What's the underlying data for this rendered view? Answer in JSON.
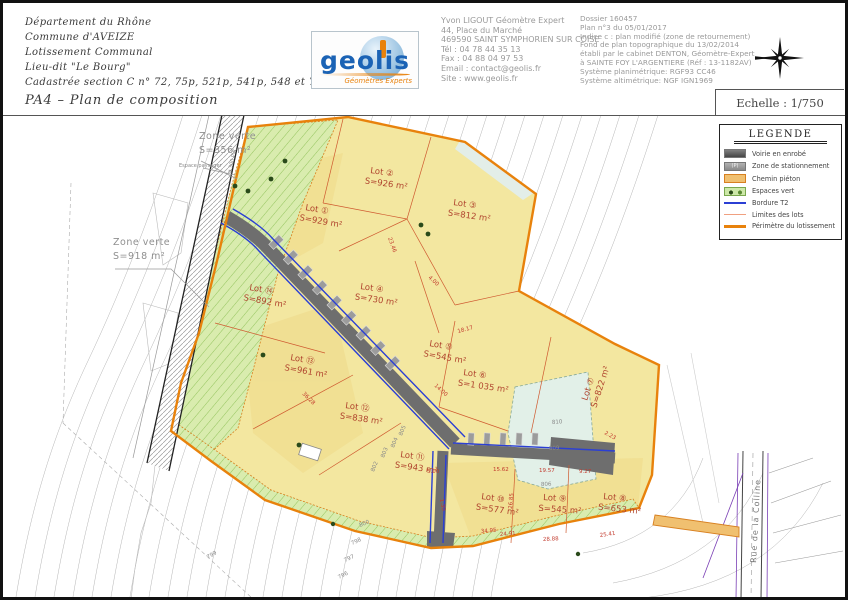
{
  "header": {
    "left_lines": [
      "Département du Rhône",
      "Commune d'AVEIZE",
      "Lotissement Communal",
      "Lieu-dit \"Le Bourg\"",
      "Cadastrée section C n° 72, 75p, 521p, 541p, 548 et 702",
      "PA4 – Plan de composition"
    ],
    "logo": {
      "name": "geolis",
      "tagline": "Géomètres Experts"
    },
    "contact_lines": [
      "Yvon LIGOUT Géomètre Expert",
      "44, Place du Marché",
      "469590 SAINT SYMPHORIEN SUR COISE",
      "Tél : 04 78 44 35 13",
      "Fax : 04 88 04 97 53",
      "Email : contact@geolis.fr",
      "Site : www.geolis.fr"
    ],
    "dossier_lines": [
      "Dossier 160457",
      "Plan n°3 du 05/01/2017",
      "Indice c : plan modifié (zone de retournement)",
      "Fond de plan topographique du 13/02/2014",
      "établi par le cabinet DENTON, Géomètre-Expert",
      "à SAINTE FOY L'ARGENTIERE (Réf : 13-1182AV)",
      "Système planimétrique: RGF93 CC46",
      "Système altimétrique: NGF IGN1969"
    ],
    "scale": "Echelle : 1/750"
  },
  "legend": {
    "title": "LEGENDE",
    "entries": [
      {
        "label": "Voirie en enrobé",
        "swatch": "road",
        "swatch_text": ""
      },
      {
        "label": "Zone de stationnement",
        "swatch": "parking",
        "swatch_text": "(P)"
      },
      {
        "label": "Chemin piéton",
        "swatch": "path",
        "swatch_text": ""
      },
      {
        "label": "Espaces vert",
        "swatch": "green",
        "swatch_text": ""
      },
      {
        "label": "Bordure T2",
        "swatch": "bordure",
        "swatch_text": ""
      },
      {
        "label": "Limites des lots",
        "swatch": "limites",
        "swatch_text": ""
      },
      {
        "label": "Périmètre du lotissement",
        "swatch": "perimetre",
        "swatch_text": ""
      }
    ]
  },
  "map": {
    "lots": [
      {
        "name": "Lot ①",
        "area": "S=929 m²",
        "x": 302,
        "y": 207,
        "rot": 10
      },
      {
        "name": "Lot ②",
        "area": "S=926 m²",
        "x": 367,
        "y": 170,
        "rot": 8
      },
      {
        "name": "Lot ③",
        "area": "S=812 m²",
        "x": 450,
        "y": 202,
        "rot": 8
      },
      {
        "name": "Lot ④",
        "area": "S=730 m²",
        "x": 357,
        "y": 286,
        "rot": 8
      },
      {
        "name": "Lot ⑤",
        "area": "S=545 m²",
        "x": 426,
        "y": 343,
        "rot": 10
      },
      {
        "name": "Lot ⑥",
        "area": "S=1 035 m²",
        "x": 460,
        "y": 372,
        "rot": 8
      },
      {
        "name": "Lot ⑦",
        "area": "S=822 m²",
        "x": 584,
        "y": 398,
        "rot": -72
      },
      {
        "name": "Lot ⑧",
        "area": "S=653 m²",
        "x": 600,
        "y": 496,
        "rot": 6
      },
      {
        "name": "Lot ⑨",
        "area": "S=545 m²",
        "x": 540,
        "y": 497,
        "rot": 4
      },
      {
        "name": "Lot ⑩",
        "area": "S=577 m²",
        "x": 478,
        "y": 496,
        "rot": 8
      },
      {
        "name": "Lot ⑪",
        "area": "S=943 m²",
        "x": 397,
        "y": 454,
        "rot": 8
      },
      {
        "name": "Lot ⑫",
        "area": "S=838 m²",
        "x": 342,
        "y": 405,
        "rot": 8
      },
      {
        "name": "Lot ⑬",
        "area": "S=961 m²",
        "x": 287,
        "y": 357,
        "rot": 10
      },
      {
        "name": "Lot ⑭",
        "area": "S=892 m²",
        "x": 246,
        "y": 287,
        "rot": 10
      }
    ],
    "zones": [
      {
        "name": "Zone verte",
        "area": "S=356 m²",
        "x": 196,
        "y": 136
      },
      {
        "name": "Zone verte",
        "area": "S=918 m²",
        "x": 110,
        "y": 242
      }
    ],
    "labels": {
      "espace": "Espace paysager",
      "pipe": "ø 300 PVC",
      "street": "Rue de la Colline"
    },
    "contour_labels": [
      {
        "t": "800",
        "x": 357,
        "y": 524,
        "r": -22
      },
      {
        "t": "798",
        "x": 349,
        "y": 542,
        "r": -24
      },
      {
        "t": "797",
        "x": 342,
        "y": 559,
        "r": -25
      },
      {
        "t": "796",
        "x": 336,
        "y": 576,
        "r": -26
      },
      {
        "t": "799",
        "x": 205,
        "y": 556,
        "r": -30
      },
      {
        "t": "805",
        "x": 399,
        "y": 433,
        "r": -68
      },
      {
        "t": "804",
        "x": 391,
        "y": 445,
        "r": -68
      },
      {
        "t": "803",
        "x": 381,
        "y": 455,
        "r": -68
      },
      {
        "t": "802",
        "x": 371,
        "y": 469,
        "r": -68
      },
      {
        "t": "810",
        "x": 549,
        "y": 421,
        "r": -4
      },
      {
        "t": "809",
        "x": 546,
        "y": 447,
        "r": -3
      },
      {
        "t": "806",
        "x": 538,
        "y": 483,
        "r": -2
      }
    ],
    "dimensions": [
      {
        "t": "15.62",
        "x": 490,
        "y": 468,
        "r": 0
      },
      {
        "t": "19.57",
        "x": 536,
        "y": 469,
        "r": 0
      },
      {
        "t": "9.27",
        "x": 576,
        "y": 470,
        "r": 0
      },
      {
        "t": "26.85",
        "x": 509,
        "y": 506,
        "r": -85
      },
      {
        "t": "24.91",
        "x": 497,
        "y": 533,
        "r": -4
      },
      {
        "t": "28.88",
        "x": 540,
        "y": 538,
        "r": -3
      },
      {
        "t": "25.41",
        "x": 597,
        "y": 534,
        "r": -8
      },
      {
        "t": "34.95",
        "x": 478,
        "y": 530,
        "r": -5
      },
      {
        "t": "14.00",
        "x": 431,
        "y": 383,
        "r": 42
      },
      {
        "t": "4.00",
        "x": 425,
        "y": 275,
        "r": 42
      },
      {
        "t": "23.46",
        "x": 385,
        "y": 235,
        "r": 70
      },
      {
        "t": "18.17",
        "x": 455,
        "y": 330,
        "r": -15
      },
      {
        "t": "5.00",
        "x": 424,
        "y": 470,
        "r": 0
      },
      {
        "t": "36.28",
        "x": 299,
        "y": 391,
        "r": 45
      },
      {
        "t": "2.23",
        "x": 601,
        "y": 431,
        "r": 28
      },
      {
        "t": "1.30",
        "x": 437,
        "y": 496,
        "r": 80
      }
    ]
  },
  "colors": {
    "perimeter": "#e8820c",
    "lot_fill": "#f3e7a0",
    "green_fill": "#d9ecae",
    "road_fill": "#6e6e6e",
    "bordure_blue": "#2b3fd4",
    "lot_limit": "#cf5a30",
    "basin_fill": "#e2f0e8"
  }
}
